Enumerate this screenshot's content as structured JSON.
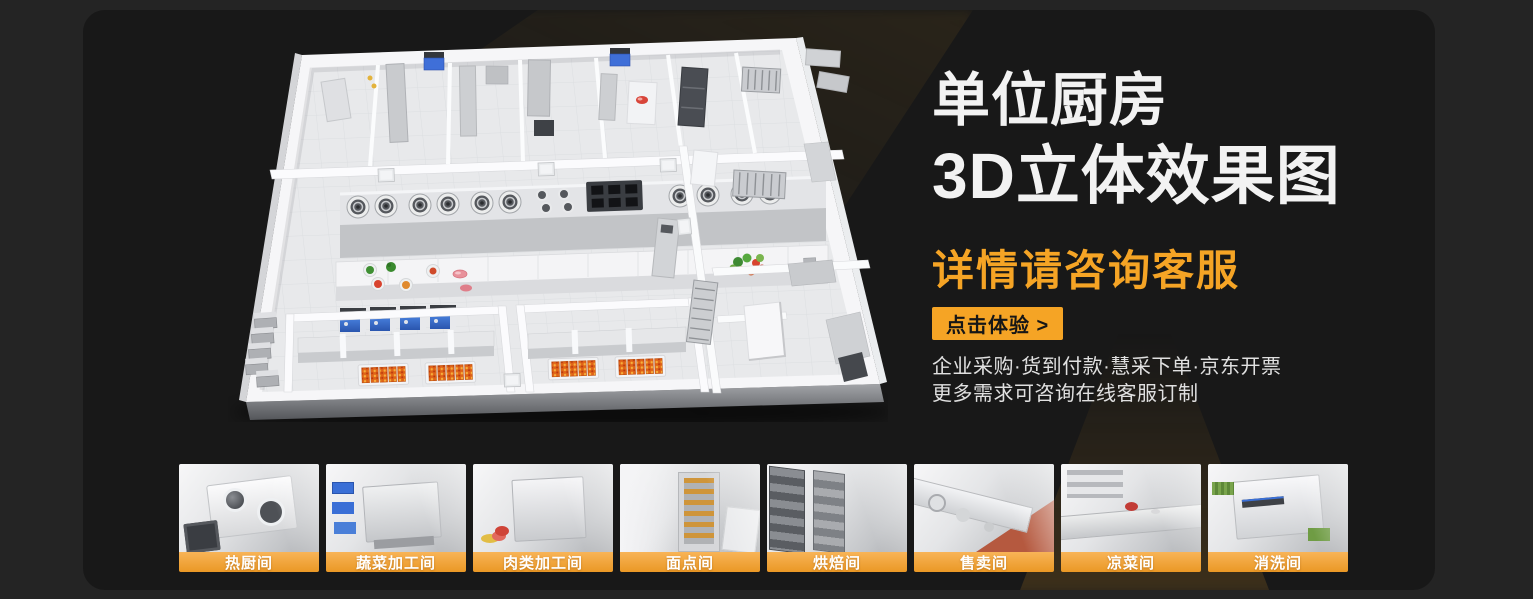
{
  "hero": {
    "title_line1": "单位厨房",
    "title_line2": "3D立体效果图",
    "subtitle": "详情请咨询客服",
    "cta_label": "点击体验 >",
    "info_line1": "企业采购·货到付款·慧采下单·京东开票",
    "info_line2": "更多需求可咨询在线客服订制"
  },
  "thumbnails": {
    "items": [
      {
        "label": "热厨间"
      },
      {
        "label": "蔬菜加工间"
      },
      {
        "label": "肉类加工间"
      },
      {
        "label": "面点间"
      },
      {
        "label": "烘焙间"
      },
      {
        "label": "售卖间"
      },
      {
        "label": "凉菜间"
      },
      {
        "label": "消洗间"
      }
    ]
  },
  "colors": {
    "page_background": "#242424",
    "card_background": "#181818",
    "accent_orange": "#F5A425",
    "thumb_label_gradient_top": "#F8B457",
    "thumb_label_gradient_bottom": "#EA9825",
    "heading_white": "#F2F2F2",
    "info_text": "#E0E0E0",
    "cta_text": "#161616"
  }
}
